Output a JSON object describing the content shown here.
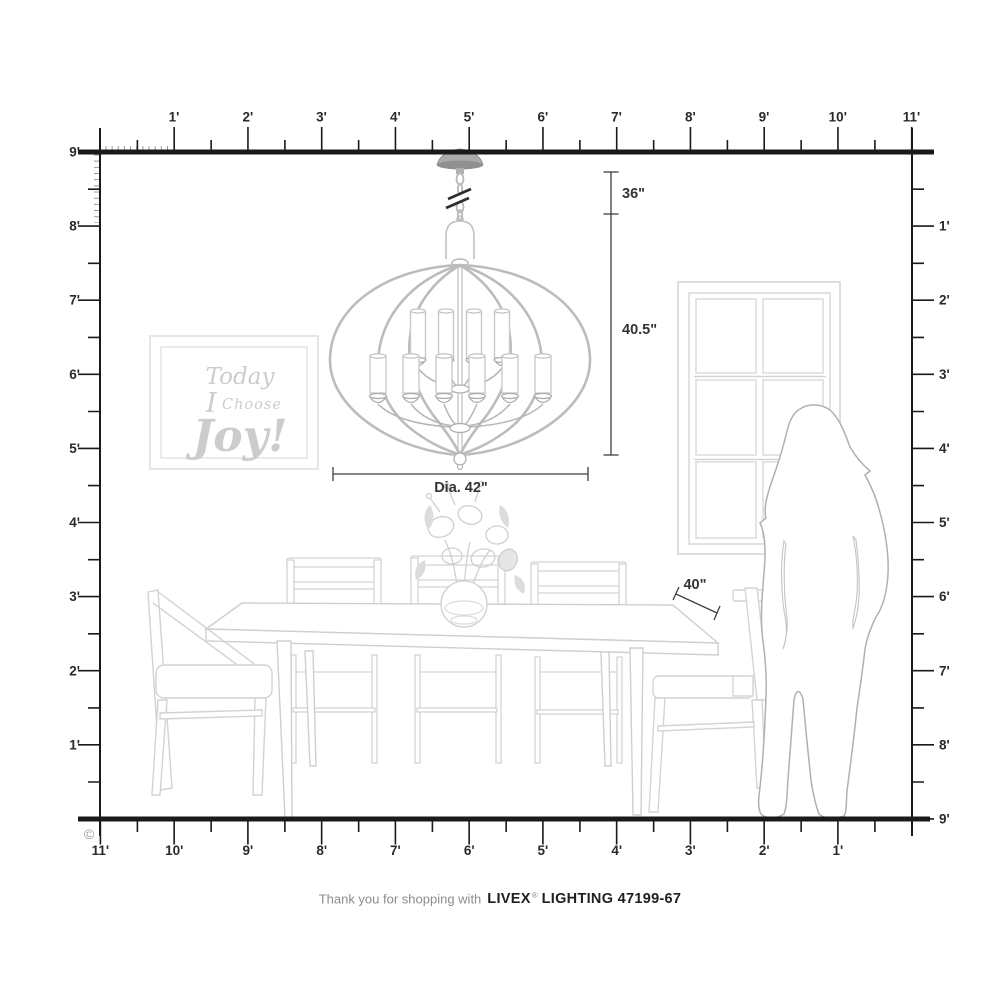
{
  "rulers": {
    "top": [
      "1'",
      "2'",
      "3'",
      "4'",
      "5'",
      "6'",
      "7'",
      "8'",
      "9'",
      "10'",
      "11'"
    ],
    "left": [
      "9'",
      "8'",
      "7'",
      "6'",
      "5'",
      "4'",
      "3'",
      "2'",
      "1'"
    ],
    "right": [
      "1'",
      "2'",
      "3'",
      "4'",
      "5'",
      "6'",
      "7'",
      "8'",
      "9'"
    ],
    "bottom": [
      "11'",
      "10'",
      "9'",
      "8'",
      "7'",
      "6'",
      "5'",
      "4'",
      "3'",
      "2'",
      "1'"
    ]
  },
  "dimensions": {
    "hang_length": "36\"",
    "fixture_height": "40.5\"",
    "fixture_diameter": "Dia. 42\"",
    "table_width": "40\""
  },
  "wall_art": {
    "line1": "Today",
    "line2_initial": "I",
    "line2_word": "Choose",
    "line3": "Joy!"
  },
  "copyright": "©",
  "footer": {
    "message": "Thank you for shopping with",
    "brand": "LIVEX",
    "registered": "®",
    "product": "LIGHTING 47199-67"
  },
  "colors": {
    "ruler": "#1a1a1a",
    "dimension_line": "#3f3f3f",
    "furniture_line": "#d2d2d2",
    "fixture_line": "#bcbcbc",
    "art_text": "#cccccc",
    "silhouette_outline": "#b0b0b0"
  }
}
